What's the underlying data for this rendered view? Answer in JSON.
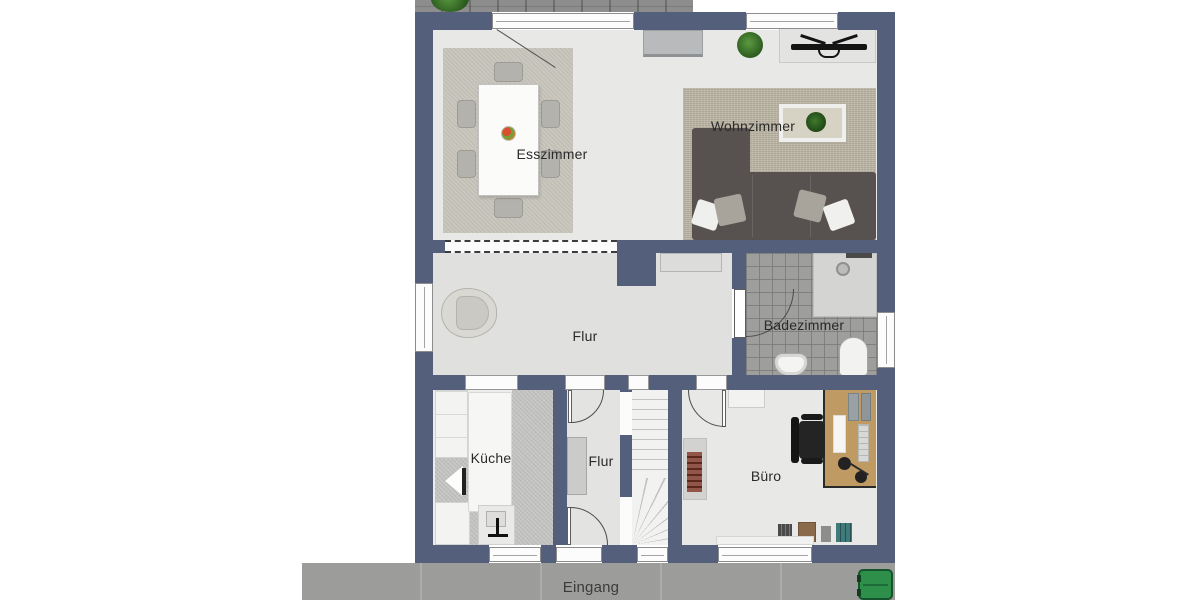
{
  "labels": {
    "esszimmer": "Esszimmer",
    "wohnzimmer": "Wohnzimmer",
    "flur_main": "Flur",
    "badezimmer": "Badezimmer",
    "kueche": "Küche",
    "flur_small": "Flur",
    "buero": "Büro",
    "eingang": "Eingang"
  },
  "colors": {
    "wall": "#535f7b",
    "floor_light": "#e8e8e7",
    "floor_flur": "#e0e0df",
    "rug_dining": "#cac7bf",
    "rug_living": "#bcb6a6",
    "sofa": "#575150",
    "tile_bath": "#9e9e9d",
    "tile_kitchen": "#c5c5c3",
    "walkway": "#9c9c9b",
    "terrace": "#8d8d8d",
    "desk_wood": "#c09a63",
    "stove": "#7c3526",
    "bin_green": "#2e8f4b",
    "plant_green": "#2c5a1f",
    "label_text": "#2a2a2a"
  }
}
